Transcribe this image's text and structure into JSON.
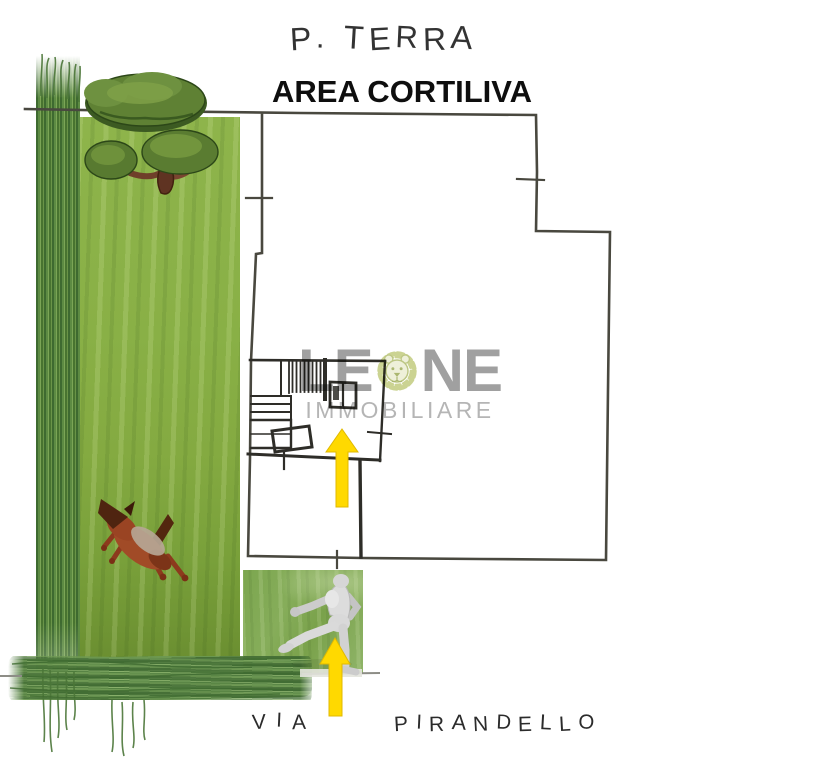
{
  "labels": {
    "floor_level": "P. TERRA",
    "courtyard": "AREA CORTILIVA",
    "street_prefix": "VIA",
    "street_name": "PIRANDELLO"
  },
  "watermark": {
    "brand_left": "LE",
    "brand_right": "NE",
    "subtitle": "IMMOBILIARE",
    "brand_color": "#9c9c9c",
    "subtitle_color": "#b2b2b2",
    "lion_fill": "#eef0d8",
    "lion_line": "#c9d28e"
  },
  "plan": {
    "ink_color": "#49483f",
    "interior_ink_color": "#2e2d28",
    "street_line_color": "#8d8d86"
  },
  "scene": {
    "lawn_green": "#85ad45",
    "tall_grass_green": "#53803c",
    "hedge_green": "#4e7c3d",
    "patch_green": "#7fa457",
    "arrow_yellow": "#ffd900",
    "tree_canopy_green": "#5f8134",
    "trunk_brown": "#5f3322",
    "dog_red_brown": "#a14b27",
    "mannequin_gray": "#dcdcdc",
    "icons": {
      "tree": "tree-top-icon",
      "dog": "running-dog-icon",
      "person": "walking-mannequin-icon",
      "arrow": "up-arrow-icon",
      "lion": "lion-head-icon"
    }
  }
}
